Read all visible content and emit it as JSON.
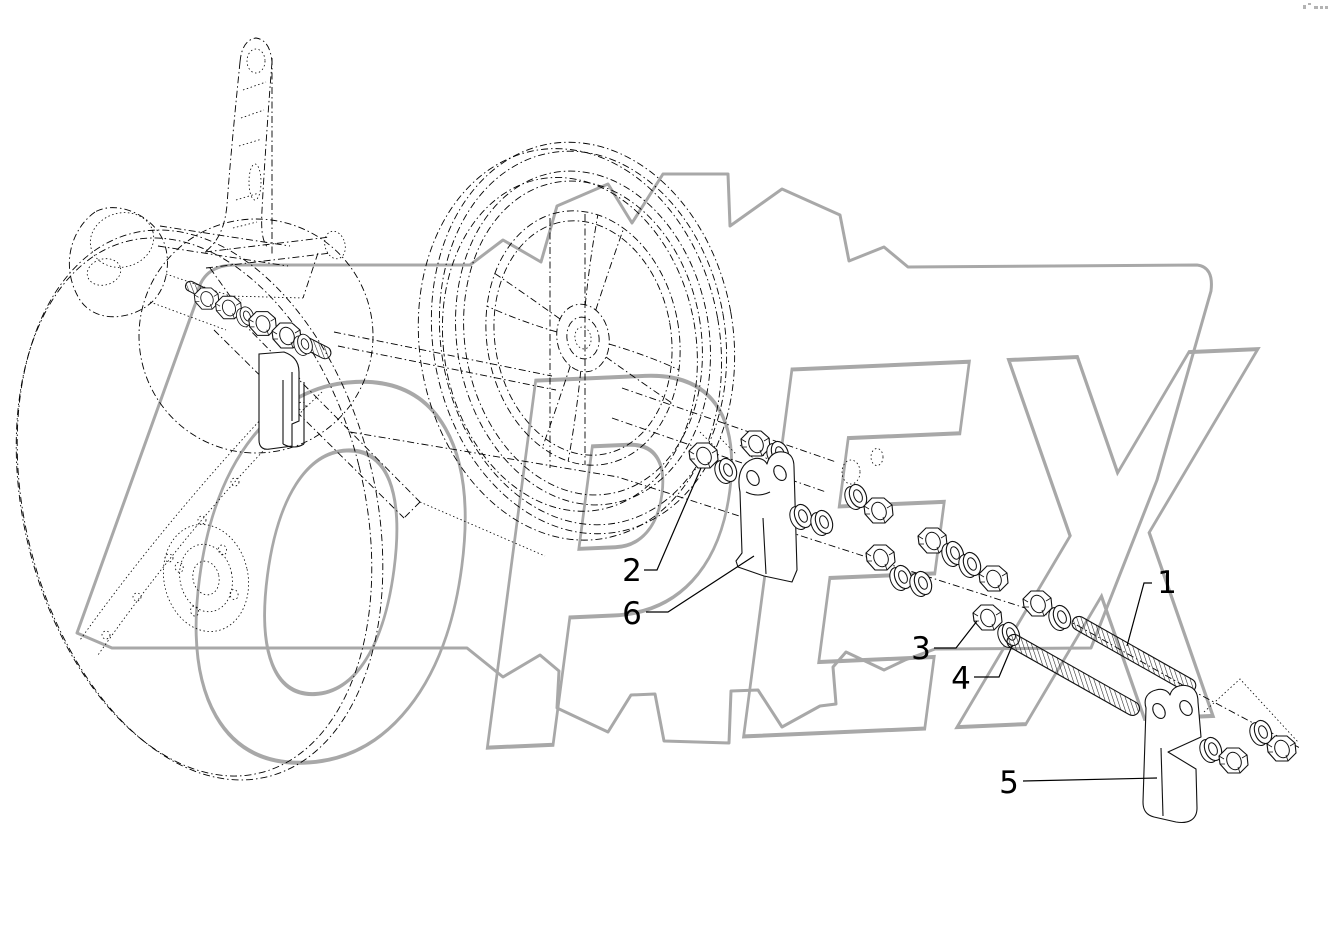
{
  "watermark": {
    "text": "OPEX",
    "color": "#a8a8a8"
  },
  "drawing": {
    "background": "#ffffff",
    "line_color": "#000000"
  },
  "callouts": [
    {
      "label": "1"
    },
    {
      "label": "2"
    },
    {
      "label": "3"
    },
    {
      "label": "4"
    },
    {
      "label": "5"
    },
    {
      "label": "6"
    }
  ]
}
